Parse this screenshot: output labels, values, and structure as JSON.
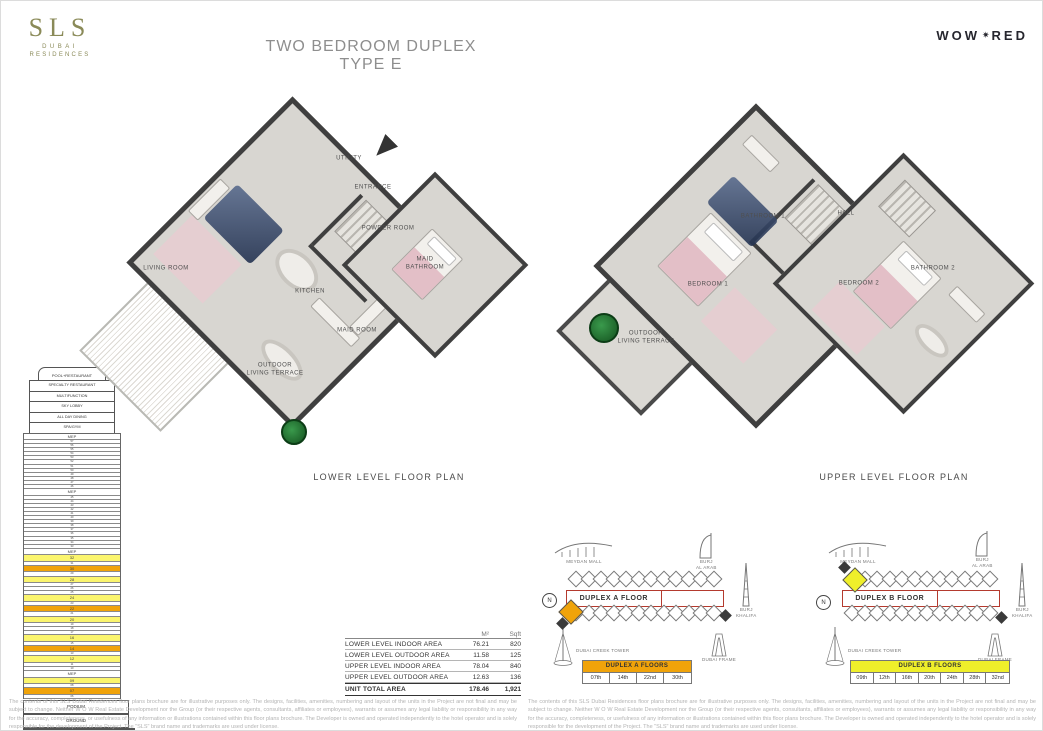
{
  "header": {
    "logo": {
      "brand": "SLS",
      "sub1": "DUBAI",
      "sub2": "RESIDENCES"
    },
    "title": "TWO BEDROOM DUPLEX TYPE E",
    "wow_logo": {
      "wow": "WOW",
      "icon_glyph": "✷",
      "red": "RED"
    }
  },
  "plans": {
    "lower": {
      "caption": "LOWER LEVEL FLOOR PLAN",
      "rooms": {
        "utility": "UTILITY",
        "entrance": "ENTRANCE",
        "powder_room": "POWDER ROOM",
        "maid_bathroom": "MAID\nBATHROOM",
        "living_room": "LIVING ROOM",
        "kitchen": "KITCHEN",
        "maid_room": "MAID ROOM",
        "terrace": "OUTDOOR\nLIVING TERRACE"
      }
    },
    "upper": {
      "caption": "UPPER LEVEL FLOOR PLAN",
      "rooms": {
        "bathroom1": "BATHROOM 1",
        "hall": "HALL",
        "bedroom1": "BEDROOM 1",
        "bedroom2": "BEDROOM 2",
        "bathroom2": "BATHROOM 2",
        "terrace": "OUTDOOR\nLIVING TERRACE"
      }
    }
  },
  "tower": {
    "cap_label": "POOL+RESTAURANT",
    "amenities": [
      "SPECIALTY RESTAURANT",
      "MULTIFUNCTION",
      "SKY LOBBY",
      "ALL DAY DINING",
      "SPA/GYM"
    ],
    "mep_label": "MEP",
    "floor_rows": [
      "MEP",
      "57",
      "56",
      "55",
      "54",
      "53",
      "52",
      "51",
      "50",
      "49",
      "48",
      "47",
      "46",
      "MEP",
      "45",
      "44",
      "43",
      "42",
      "41",
      "40",
      "39",
      "38",
      "37",
      "36",
      "35",
      "34",
      "33",
      "MEP",
      "32",
      "31",
      "30",
      "29",
      "28",
      "27",
      "26",
      "25",
      "24",
      "23",
      "22",
      "21",
      "20",
      "19",
      "18",
      "17",
      "16",
      "15",
      "14",
      "13",
      "12",
      "11",
      "10",
      "MEP",
      "09",
      "08",
      "07",
      "06"
    ],
    "duplex_a_floors": [
      "30",
      "22",
      "14",
      "07"
    ],
    "duplex_b_floors": [
      "32",
      "28",
      "24",
      "20",
      "16",
      "12",
      "09"
    ],
    "podium_label": "PODIUM",
    "ground_label": "GROUND",
    "colors": {
      "duplex_a": "#F0A30A",
      "duplex_b": "#FBF56E"
    }
  },
  "area_table": {
    "unit_headers": [
      "M²",
      "Sqft"
    ],
    "rows": [
      {
        "label": "LOWER LEVEL INDOOR AREA",
        "m2": "76.21",
        "sqft": "820"
      },
      {
        "label": "LOWER LEVEL OUTDOOR AREA",
        "m2": "11.58",
        "sqft": "125"
      },
      {
        "label": "UPPER LEVEL INDOOR AREA",
        "m2": "78.04",
        "sqft": "840"
      },
      {
        "label": "UPPER LEVEL OUTDOOR AREA",
        "m2": "12.63",
        "sqft": "136"
      }
    ],
    "total": {
      "label": "UNIT TOTAL AREA",
      "m2": "178.46",
      "sqft": "1,921"
    }
  },
  "locators": {
    "landmarks": {
      "meydan_mall": "MEYDAN MALL",
      "burj_al_arab": "BURJ\nAL ARAB",
      "burj_khalifa": "BURJ\nKHALIFA",
      "dubai_creek_tower": "DUBAI CREEK TOWER",
      "dubai_frame": "DUBAI FRAME",
      "compass": "N"
    },
    "a": {
      "plate_label": "DUPLEX A FLOOR",
      "table_title": "DUPLEX A FLOORS",
      "floors": [
        "07th",
        "14th",
        "22nd",
        "30th"
      ],
      "accent": "#F0A30A"
    },
    "b": {
      "plate_label": "DUPLEX B FLOOR",
      "table_title": "DUPLEX B FLOORS",
      "floors": [
        "09th",
        "12th",
        "16th",
        "20th",
        "24th",
        "28th",
        "32nd"
      ],
      "accent": "#EFEF2A"
    }
  },
  "disclaimer": "The contents of this SLS Dubai Residences floor plans brochure are for illustrative purposes only. The designs, facilities, amenities, numbering and layout of the units in the Project are not final and may be subject to change. Neither W O W Real Estate Development nor the Group (or their respective agents, consultants, affiliates or employees), warrants or assumes any legal liability or responsibility in any way for the accuracy, completeness, or usefulness of any information or illustrations contained within this floor plans brochure. The Developer is owned and operated independently to the hotel operator and is solely responsible for the development of the Project. The \"SLS\" brand name and trademarks are used under license."
}
